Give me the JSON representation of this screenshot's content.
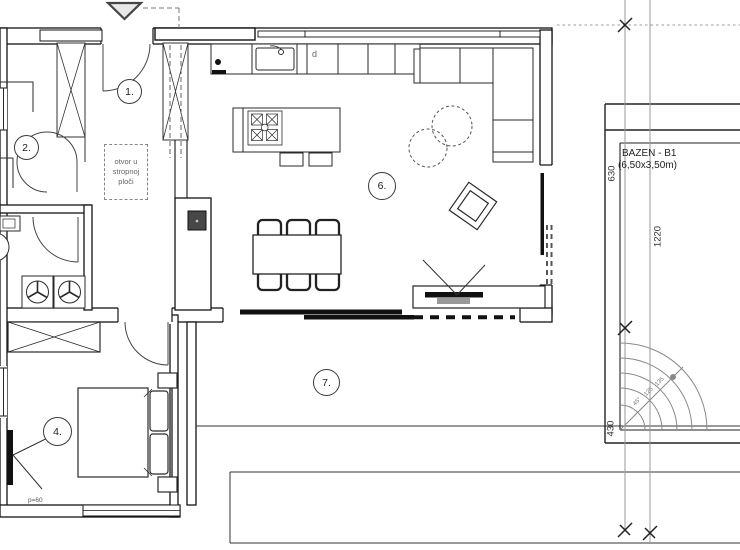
{
  "plan": {
    "room_labels": {
      "entry": "1.",
      "bedroom2": "2.",
      "bedroom4": "4.",
      "living": "6.",
      "terrace": "7."
    },
    "notes": {
      "ceiling_opening": "otvor u stropnoj ploči",
      "dishwasher": "d",
      "bed_note": "p=60"
    },
    "pool": {
      "name": "BAZEN - B1",
      "size": "(6,50x3,50m)",
      "slope_labels": [
        "45°",
        "125",
        "135"
      ]
    },
    "dimensions": {
      "dim_630": "630",
      "dim_1220": "1220",
      "dim_430": "430"
    }
  }
}
